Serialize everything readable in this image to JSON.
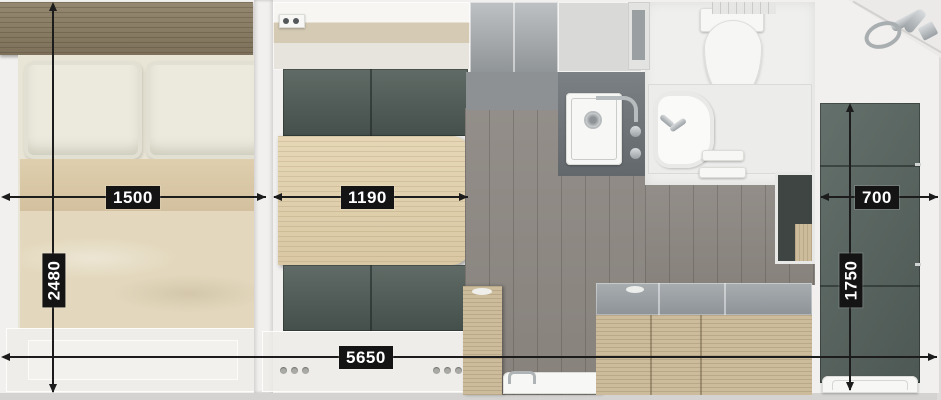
{
  "floorplan": {
    "title": "Caravan floor plan (top view)",
    "dimensions": {
      "bed_width": "1500",
      "table_length": "1190",
      "wardrobe_width": "700",
      "bedroom_depth": "2480",
      "wardrobe_depth": "1750",
      "overall_length": "5650"
    },
    "rooms": {
      "left": "double bed with two pillows and headboard shelf",
      "middle": "dinette with table and two upholstered benches",
      "center": "kitchen with sink, counter and refrigerator cabinet",
      "right_top": "bathroom with toilet, washbasin and shower head",
      "right": "wardrobe / shower cubicle with tray"
    },
    "colors": {
      "dim_label_bg": "#141414",
      "dim_label_text": "#ffffff",
      "dim_line": "#1c1c1c",
      "bench_upholstery": "#4e5a55",
      "table_wood": "#e0d0ae",
      "headboard_wood": "#8c7f67",
      "bedding_beige": "#e3d8bd",
      "floor_grey": "#8e8984",
      "wardrobe_grey": "#5a6561",
      "kitchen_wood": "#cdbc9c",
      "wall_white": "#f1f0ee"
    }
  }
}
